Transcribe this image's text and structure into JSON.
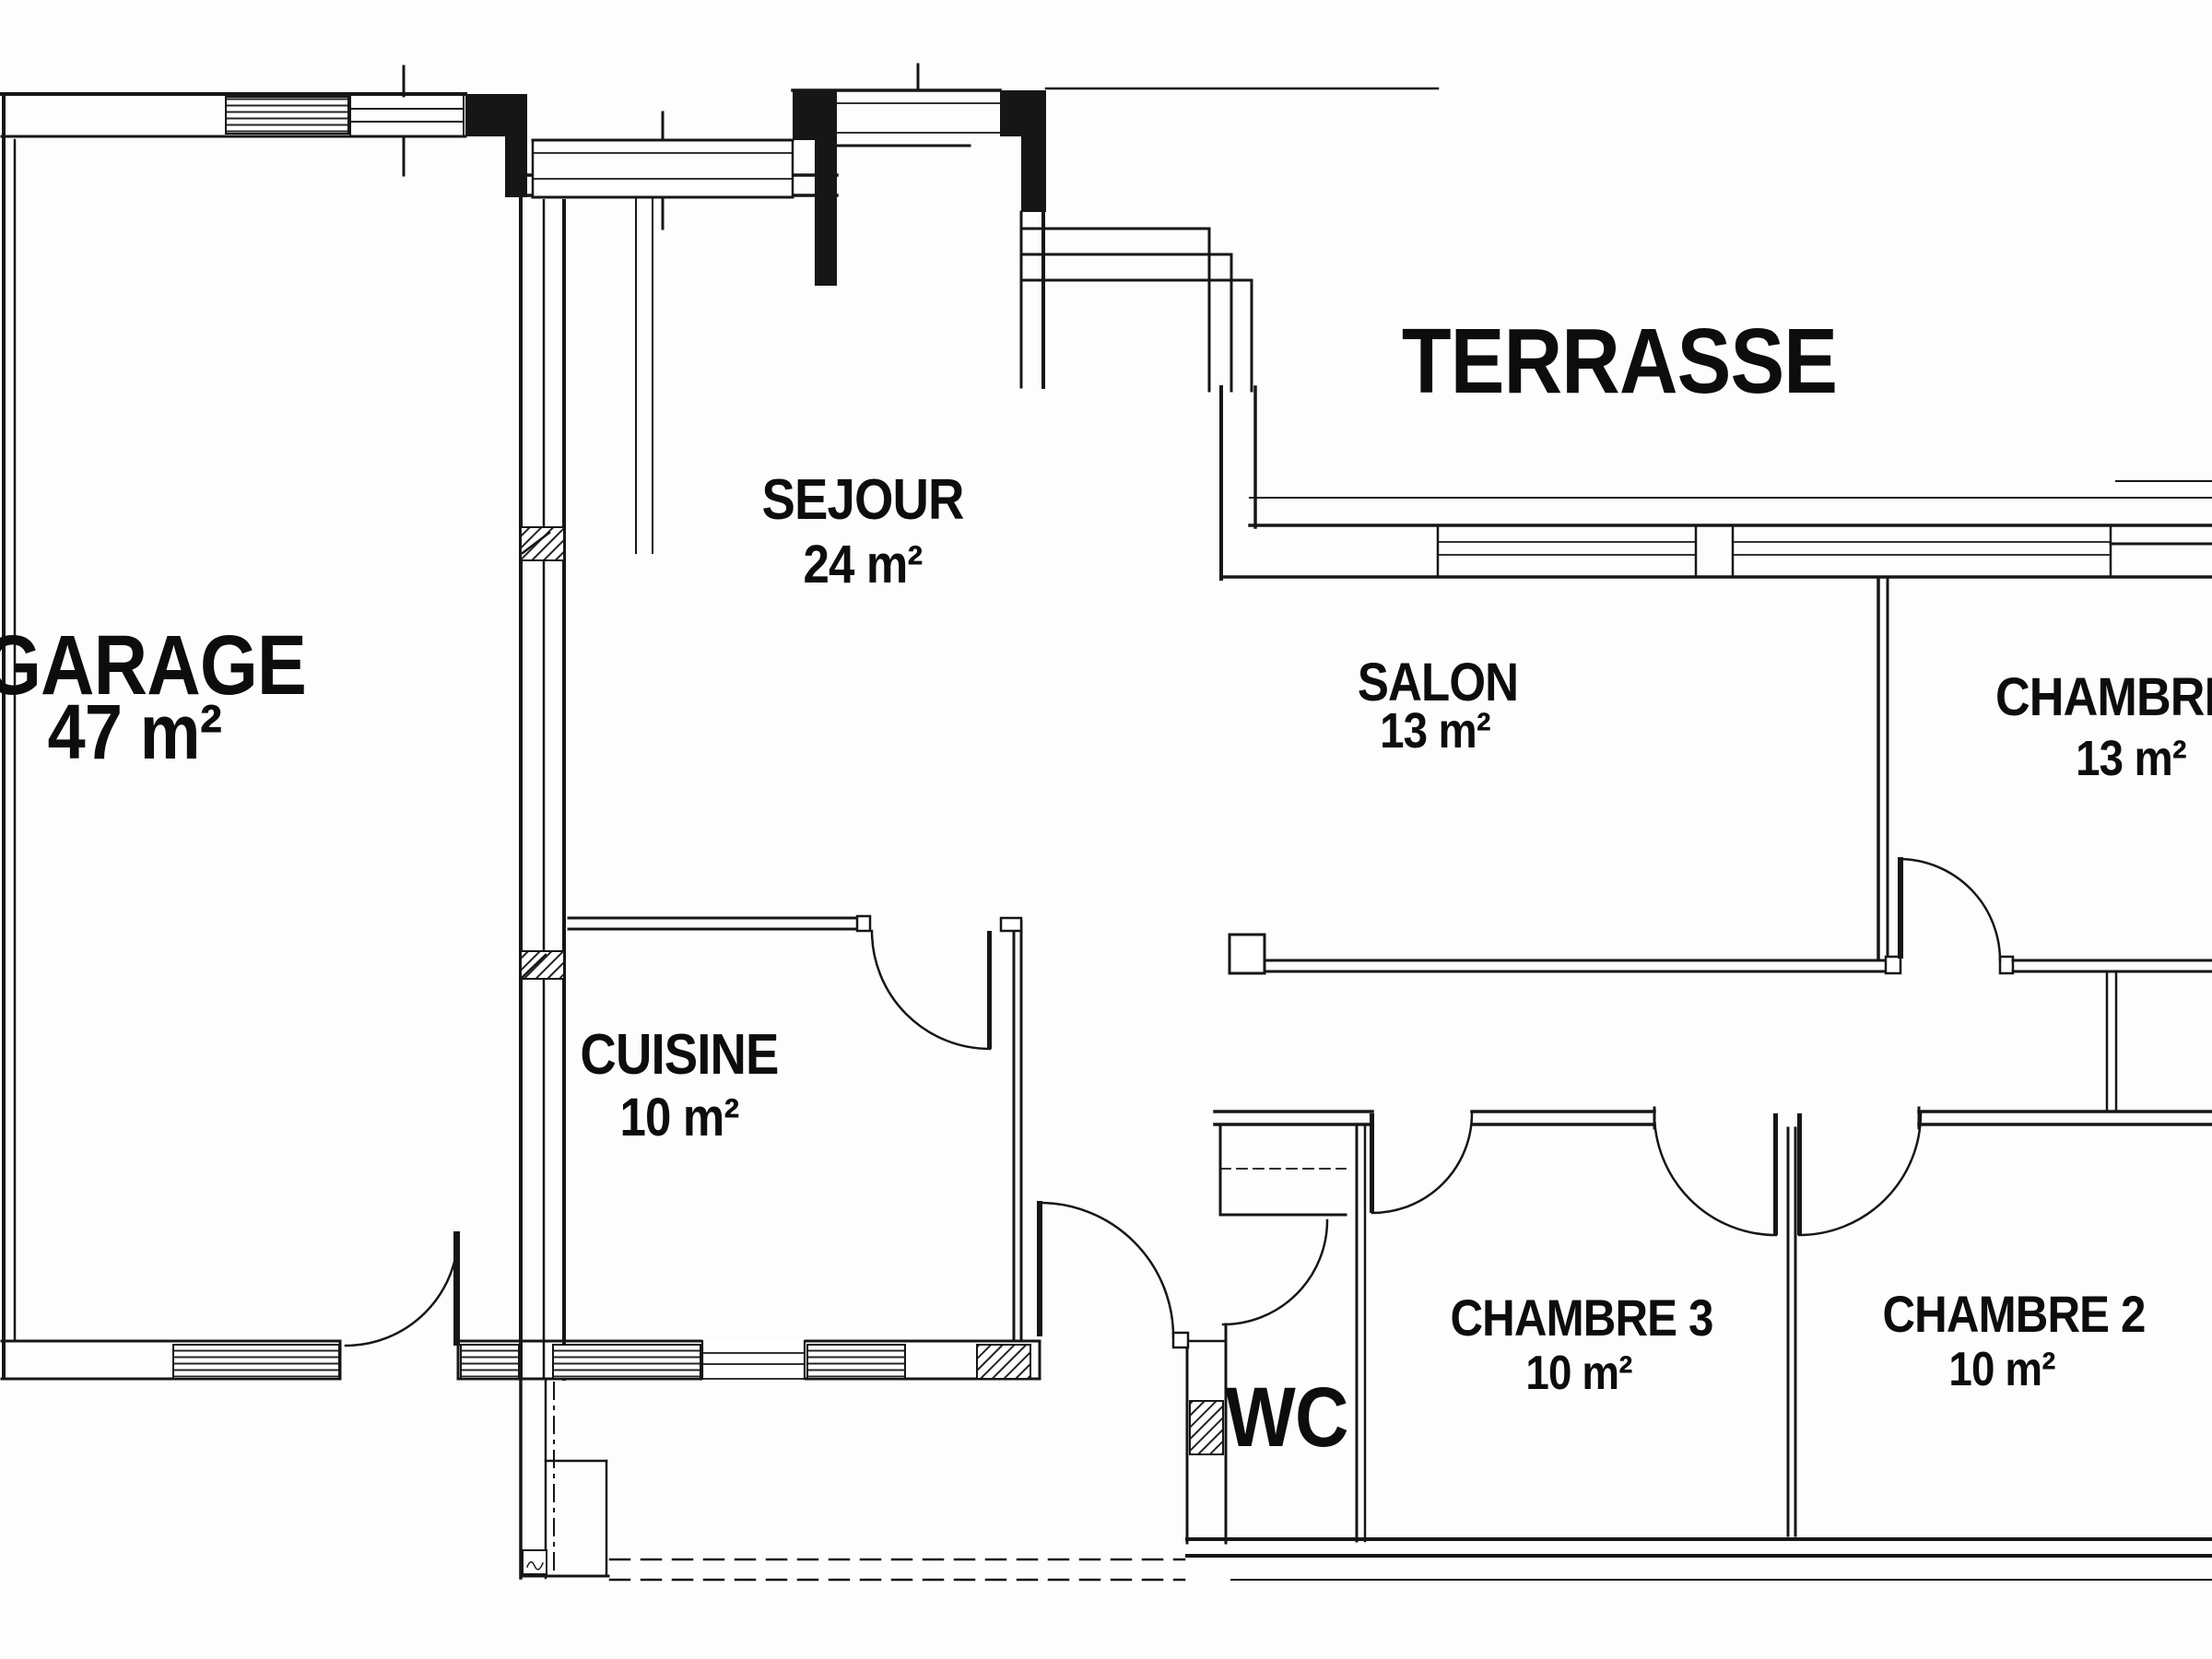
{
  "document": {
    "type": "floor-plan",
    "language": "fr",
    "style": "scanned black-line architectural drawing"
  },
  "colors": {
    "line": "#161616",
    "background": "#fdfdfd",
    "text": "#0d0d0d"
  },
  "rooms": {
    "garage": {
      "name": "GARAGE",
      "area": "47 m²"
    },
    "sejour": {
      "name": "SEJOUR",
      "area": "24 m²"
    },
    "terrasse": {
      "name": "TERRASSE",
      "area": ""
    },
    "salon": {
      "name": "SALON",
      "area": "13 m²"
    },
    "chambre1": {
      "name": "CHAMBRE",
      "area": "13 m²"
    },
    "cuisine": {
      "name": "CUISINE",
      "area": "10 m²"
    },
    "wc": {
      "name": "WC",
      "area": ""
    },
    "chambre3": {
      "name": "CHAMBRE 3",
      "area": "10 m²"
    },
    "chambre2": {
      "name": "CHAMBRE 2",
      "area": "10 m²"
    }
  }
}
